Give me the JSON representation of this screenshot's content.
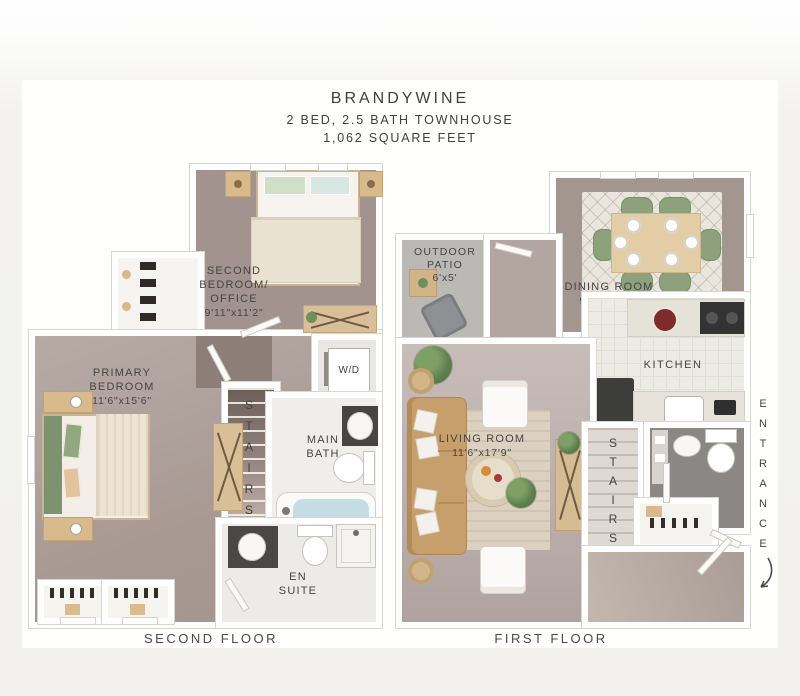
{
  "title": {
    "name": "BRANDYWINE",
    "subtitle": "2 BED, 2.5 BATH TOWNHOUSE",
    "area": "1,062 SQUARE FEET"
  },
  "palette": {
    "page_bg": "#f2f1ee",
    "card_bg": "#ffffff",
    "floor_mauve": "#a3948e",
    "floor_light_mauve": "#c0b4af",
    "wall_line": "#d9d5d1",
    "wood_tan": "#d9ba8d",
    "sage_green": "#8ca17c",
    "tub_blue": "#c4dde2",
    "dark_fixture": "#3d3c3a",
    "patio_concrete": "#bab9b5",
    "label_text": "#454545"
  },
  "second_floor": {
    "caption": "SECOND FLOOR",
    "labels": {
      "second_bedroom": {
        "l1": "SECOND",
        "l2": "BEDROOM/",
        "l3": "OFFICE",
        "dims": "9'11\"x11'2\""
      },
      "primary_bedroom": {
        "l1": "PRIMARY",
        "l2": "BEDROOM",
        "dims": "11'6\"x15'6\""
      },
      "main_bath": {
        "l1": "MAIN",
        "l2": "BATH"
      },
      "en_suite": {
        "l1": "EN",
        "l2": "SUITE"
      },
      "stairs": "STAIRS",
      "washer_dryer": "W/D"
    }
  },
  "first_floor": {
    "caption": "FIRST FLOOR",
    "labels": {
      "outdoor_patio": {
        "l1": "OUTDOOR",
        "l2": "PATIO",
        "dims": "6'x5'"
      },
      "dining_room": {
        "l1": "DINING ROOM",
        "dims": "9'11\"x11'2\""
      },
      "kitchen": "KITCHEN",
      "living_room": {
        "l1": "LIVING ROOM",
        "dims": "11'6\"x17'9\""
      },
      "stairs": "STAIRS",
      "entrance": "ENTRANCE"
    }
  }
}
